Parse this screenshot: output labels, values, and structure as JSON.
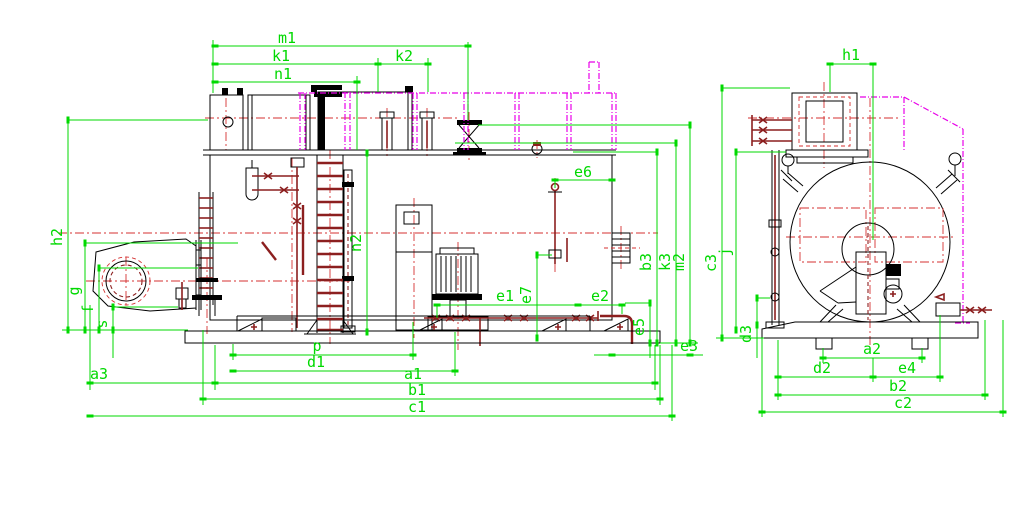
{
  "drawing_title": "boiler-general-arrangement-drawing",
  "colors": {
    "bg": "#ffffff",
    "outline": "#000000",
    "dim": "#00d900",
    "center": "#d43131",
    "pipe": "#8c1f1f",
    "phantom": "#e800e8"
  },
  "dims": {
    "m1": "m1",
    "k1": "k1",
    "k2": "k2",
    "n1": "n1",
    "h2": "h2",
    "g": "g",
    "f": "f",
    "s": "s",
    "a3": "a3",
    "n2": "n2",
    "p": "p",
    "d1": "d1",
    "a1": "a1",
    "b1": "b1",
    "c1": "c1",
    "e1": "e1",
    "e2": "e2",
    "e3": "e3",
    "e5": "e5",
    "e6": "e6",
    "e7": "e7",
    "b3": "b3",
    "k3": "k3",
    "m2": "m2",
    "h1": "h1",
    "c3": "c3",
    "j": "j",
    "d3": "d3",
    "a2": "a2",
    "d2": "d2",
    "e4": "e4",
    "b2": "b2",
    "c2": "c2"
  }
}
